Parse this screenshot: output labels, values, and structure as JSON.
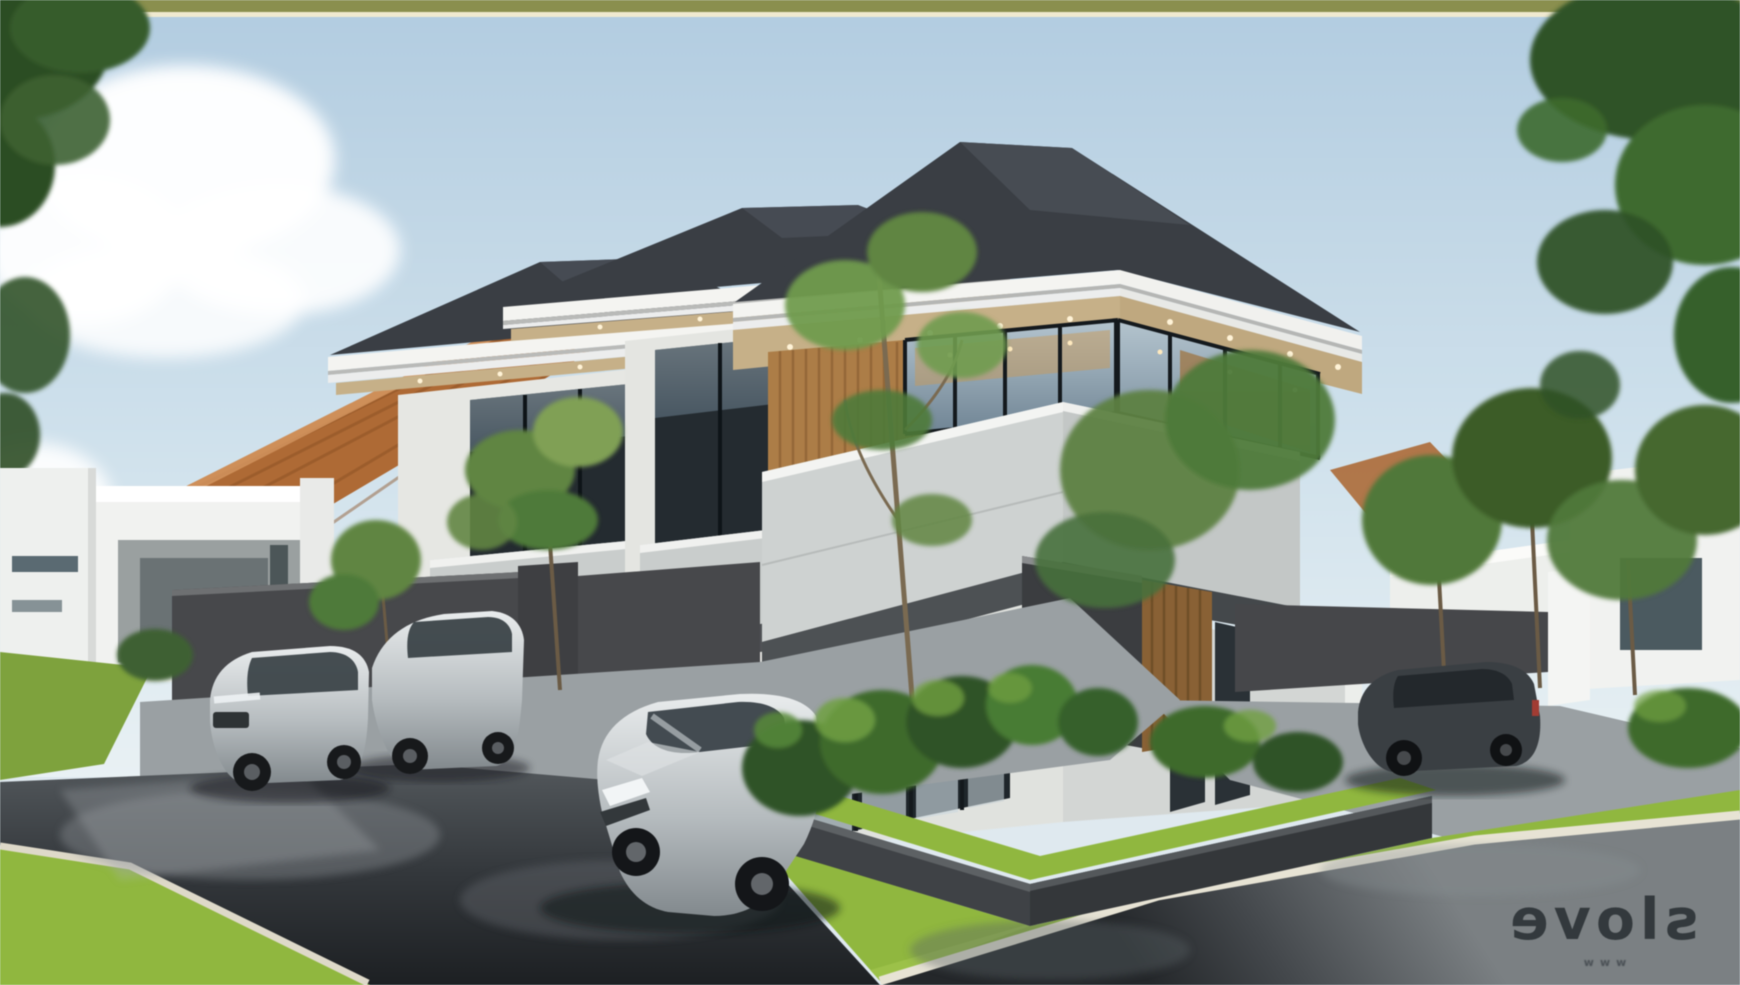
{
  "meta": {
    "title": "Modern two-storey townhouse exterior rendering",
    "type": "3d-architectural-visualization",
    "setting": "row of modern hip-roof townhouses on a wet street corner with parked cars, lawns and a tropical corner planter"
  },
  "watermark": {
    "main_text": "slove",
    "sub_text": "www",
    "mirrored": true
  },
  "palette": {
    "frame_olive": "#8a8f4c",
    "frame_cream": "#efe9cf",
    "sky_top": "#b4cfe3",
    "sky_horizon": "#e9f1f4",
    "roof_dark": "#3a3e44",
    "roof_facet": "#4b5058",
    "fascia_white": "#f4f4f1",
    "fascia_tan": "#c7b087",
    "wood": "#ad7d45",
    "wood_dark": "#8a6133",
    "wall_white": "#e9eae6",
    "parapet": "#ced2d1",
    "slab_dark": "#4d5154",
    "glass_top": "#aebfca",
    "glass_bottom": "#6e8495",
    "amber_interior": "#c89a58",
    "terracotta": "#b06a33",
    "fence": "#47484b",
    "pavement": "#9aa0a3",
    "road_top": "#4a4f53",
    "road_bottom": "#212427",
    "grass": "#7da23a",
    "lawn": "#8fb83c",
    "curb": "#e7e3d4",
    "plant_dark": "#2f5226",
    "plant_mid": "#477c33",
    "tree_green": "#4e7a38",
    "tree_dark": "#2c4d24",
    "car_silver": "#c3c8cb",
    "car_dark": "#35393d",
    "watermark_ink": "#1b232b"
  },
  "scene": {
    "buildings": [
      {
        "id": "far-left-house",
        "label": "single-storey white house"
      },
      {
        "id": "entrance-pavilion",
        "label": "white entrance pavilion"
      },
      {
        "id": "terracotta-roof",
        "label": "terracotta hip roof behind trees"
      },
      {
        "id": "townhouse-a",
        "label": "two-storey townhouse with dark hip roof"
      },
      {
        "id": "townhouse-b",
        "label": "two-storey townhouse with dark hip roof"
      },
      {
        "id": "corner-house",
        "label": "corner two-storey house with wrap-around glazing and wood slats"
      },
      {
        "id": "right-house",
        "label": "single-storey white house behind trees"
      }
    ],
    "vehicles": [
      {
        "id": "suv-left",
        "color": "silver"
      },
      {
        "id": "hatchback-left",
        "color": "silver-grey"
      },
      {
        "id": "sedan-front",
        "color": "silver"
      },
      {
        "id": "suv-right",
        "color": "dark grey"
      }
    ],
    "landscape": [
      "street trees",
      "corner planter with tropical plants",
      "bright lawns",
      "wet asphalt road",
      "white kerbs",
      "clouds"
    ]
  }
}
